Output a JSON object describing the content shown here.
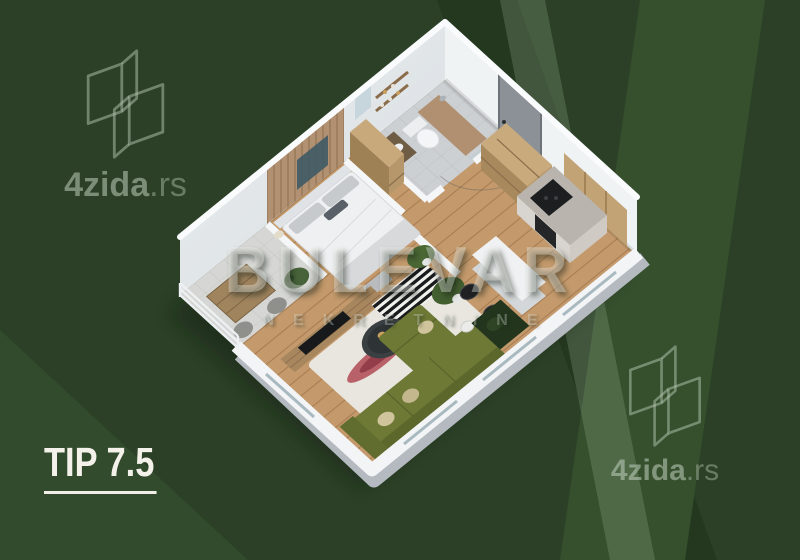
{
  "type_label": {
    "text": "TIP 7.5"
  },
  "brand_watermark": {
    "main": "4zida",
    "suffix": ".rs"
  },
  "agency_watermark": {
    "title": "BULEVAR",
    "subtitle": "NEKRETNINE"
  },
  "background": {
    "base": "#2b4026",
    "band_dark": "#243820",
    "band_light": "#36502e",
    "stripe": "#aac3a5",
    "watermark_tint": "#9fb29a"
  },
  "floorplan": {
    "style": "isometric 3D apartment render",
    "rooms": [
      "balcony",
      "bedroom",
      "bathroom",
      "hallway",
      "kitchen",
      "dining area",
      "living room"
    ],
    "furniture": [
      "double bed",
      "balcony table and chairs",
      "wardrobe",
      "toilet",
      "vanity",
      "shower",
      "tv console",
      "tv",
      "coffee table",
      "corner sofa",
      "area rug",
      "striped rug",
      "red runner rug",
      "dining table",
      "dining chairs",
      "kitchen counter",
      "cooktop",
      "oven",
      "shelving unit",
      "entrance door",
      "plants"
    ],
    "colors": {
      "walls": "#eef1f3",
      "wood_floor": "#c49a6c",
      "sofa_olive": "#6e7936",
      "balcony_floor": "#d6d7d4",
      "wood_furniture": "#b6976b",
      "label_text": "#f3f1ea"
    }
  }
}
